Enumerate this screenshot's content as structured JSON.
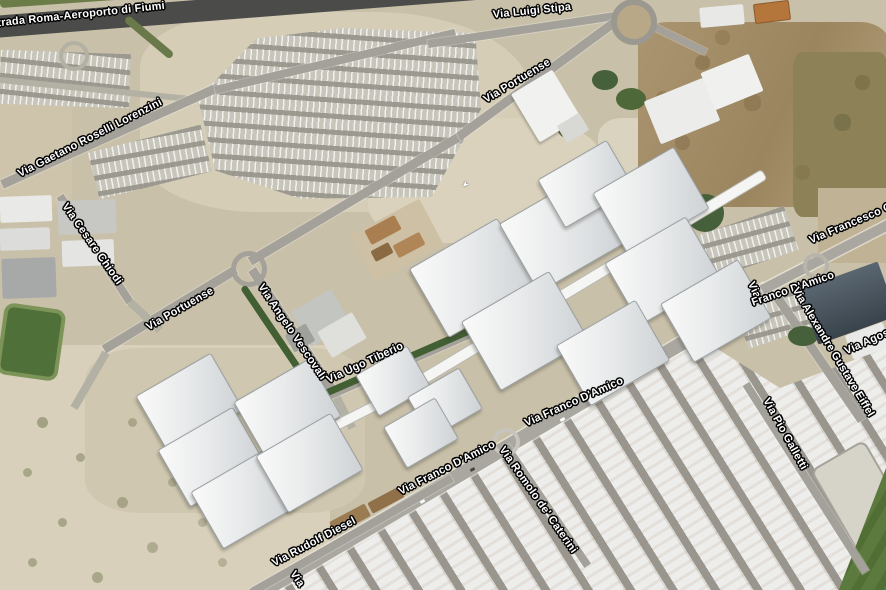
{
  "map": {
    "view_type": "satellite-imagery",
    "road_labels": [
      {
        "text": "strada Roma-Aeroporto di Fiumi"
      },
      {
        "text": "Via Luigi Stipa"
      },
      {
        "text": "Via Portuense"
      },
      {
        "text": "Via Gaetano Roselli Lorenzini"
      },
      {
        "text": "Via Cesare Chiodi"
      },
      {
        "text": "Via Portuense"
      },
      {
        "text": "Via Angelo Vescovali"
      },
      {
        "text": "Via Ugo Tiberio"
      },
      {
        "text": "Via Francesco Ci"
      },
      {
        "text": "Via"
      },
      {
        "text": "Franco D'Amico"
      },
      {
        "text": "Via Alexandre Gustave Eiffel"
      },
      {
        "text": "Via Agos"
      },
      {
        "text": "Via Franco D'Amico"
      },
      {
        "text": "Via Franco D'Amico"
      },
      {
        "text": "Via Romolo de' Caterini"
      },
      {
        "text": "Via Pio Galletti"
      },
      {
        "text": "Via Rudolf Diesel"
      },
      {
        "text": "Via"
      }
    ],
    "icons": {
      "road_arrow": "➤"
    },
    "colors": {
      "label_text": "#ffffff",
      "label_outline": "#000000",
      "terrain_tan": "#c9c0a9",
      "road_gray": "#a3a19a",
      "highway_dark": "#4b4b49",
      "vegetation_green": "#45603a",
      "building_white": "#f2f3f2",
      "warehouse_lane_gray": "#98968f"
    }
  }
}
